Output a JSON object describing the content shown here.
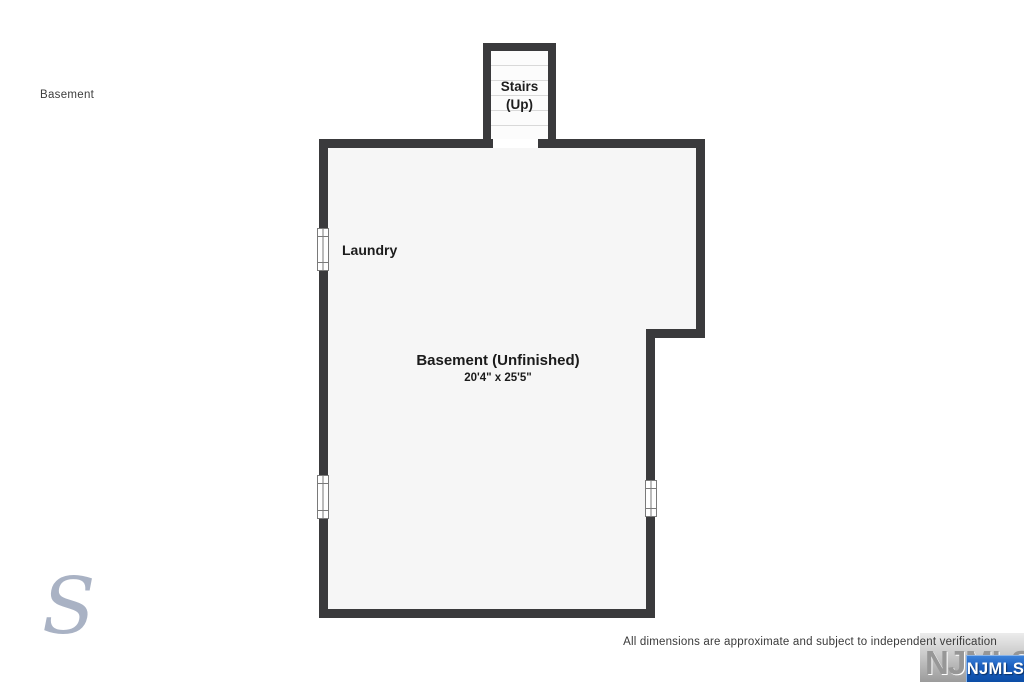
{
  "page": {
    "label": "Basement",
    "disclaimer": "All dimensions are approximate and subject to independent verification"
  },
  "floorplan": {
    "stairs": {
      "line1": "Stairs",
      "line2": "(Up)"
    },
    "laundry": {
      "label": "Laundry"
    },
    "basement": {
      "label": "Basement (Unfinished)",
      "dimensions": "20'4\" x 25'5\""
    },
    "colors": {
      "wall": "#3a3a3c",
      "room_fill": "#f6f6f6",
      "stair_tread_line": "#d9d9d9",
      "window_frame": "#7a7a7a"
    }
  },
  "watermark": {
    "letter": "S",
    "color": "#a9b2c4"
  },
  "logo": {
    "watermark_text": "NJMLS",
    "badge_text": "NJMLS",
    "badge_color": "#0c4da6"
  }
}
